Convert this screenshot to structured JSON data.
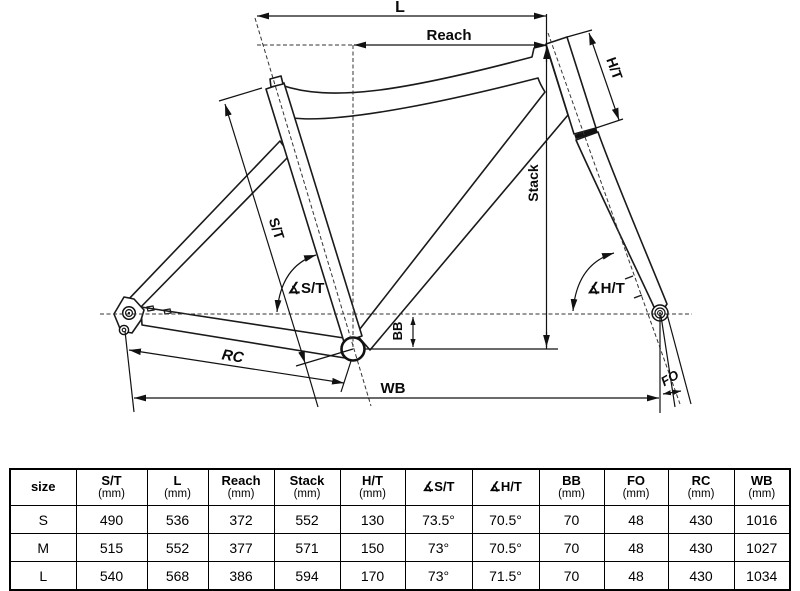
{
  "diagram": {
    "labels": {
      "l": "L",
      "reach": "Reach",
      "stack": "Stack",
      "st": "S/T",
      "ht": "H/T",
      "bb": "BB",
      "rc": "RC",
      "wb": "WB",
      "fo": "FO",
      "angle_st": "∡S/T",
      "angle_ht": "∡H/T"
    }
  },
  "table": {
    "columns": [
      {
        "label": "size",
        "unit": ""
      },
      {
        "label": "S/T",
        "unit": "(mm)"
      },
      {
        "label": "L",
        "unit": "(mm)"
      },
      {
        "label": "Reach",
        "unit": "(mm)"
      },
      {
        "label": "Stack",
        "unit": "(mm)"
      },
      {
        "label": "H/T",
        "unit": "(mm)"
      },
      {
        "label": "∡S/T",
        "unit": ""
      },
      {
        "label": "∡H/T",
        "unit": ""
      },
      {
        "label": "BB",
        "unit": "(mm)"
      },
      {
        "label": "FO",
        "unit": "(mm)"
      },
      {
        "label": "RC",
        "unit": "(mm)"
      },
      {
        "label": "WB",
        "unit": "(mm)"
      }
    ],
    "rows": [
      {
        "cells": [
          "S",
          "490",
          "536",
          "372",
          "552",
          "130",
          "73.5°",
          "70.5°",
          "70",
          "48",
          "430",
          "1016"
        ]
      },
      {
        "cells": [
          "M",
          "515",
          "552",
          "377",
          "571",
          "150",
          "73°",
          "70.5°",
          "70",
          "48",
          "430",
          "1027"
        ]
      },
      {
        "cells": [
          "L",
          "540",
          "568",
          "386",
          "594",
          "170",
          "73°",
          "71.5°",
          "70",
          "48",
          "430",
          "1034"
        ]
      }
    ]
  }
}
